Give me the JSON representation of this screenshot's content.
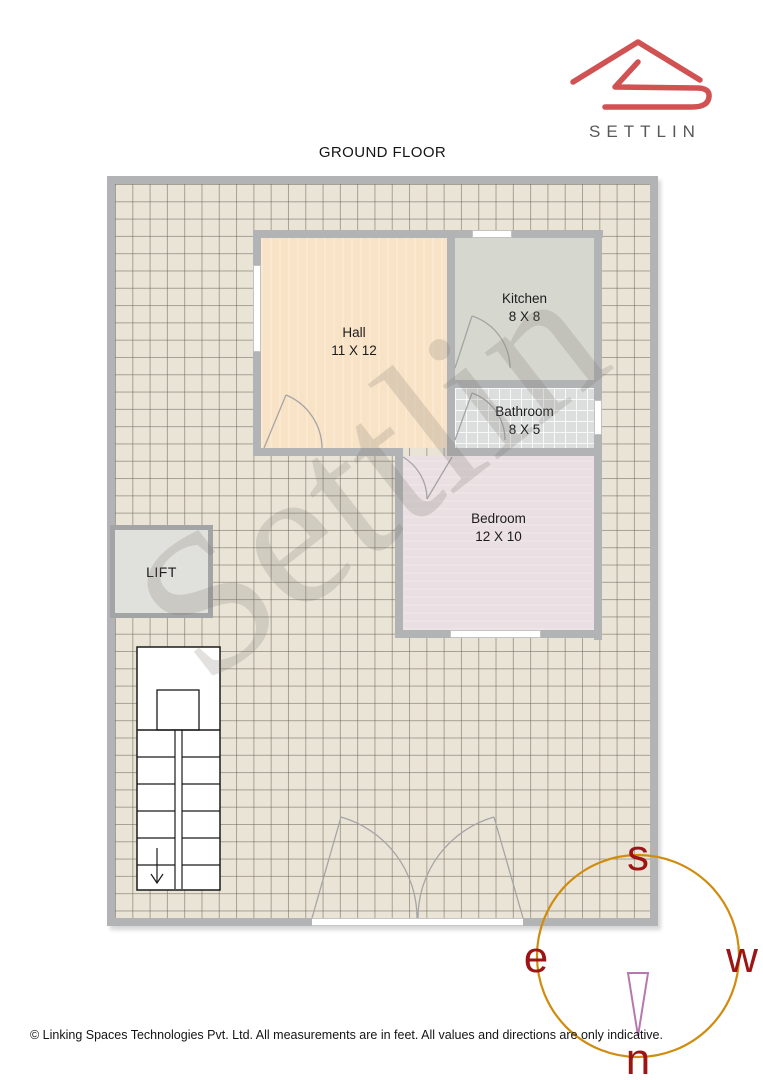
{
  "brand": {
    "name": "SETTLIN",
    "logo_color": "#d05252",
    "text_color": "#57585a"
  },
  "floor": {
    "title": "GROUND FLOOR"
  },
  "watermark": {
    "text": "Settlin"
  },
  "rooms": {
    "hall": {
      "name": "Hall",
      "size": "11 X 12",
      "fill": "#f9e3c6"
    },
    "kitchen": {
      "name": "Kitchen",
      "size": "8 X 8",
      "fill": "#d6d8d0"
    },
    "bathroom": {
      "name": "Bathroom",
      "size": "8 X 5",
      "fill": "#dcdedd"
    },
    "bedroom": {
      "name": "Bedroom",
      "size": "12 X 10",
      "fill": "#eadfe2"
    },
    "lift": {
      "name": "LIFT",
      "fill": "#e0e1dc"
    }
  },
  "compass": {
    "south": "s",
    "east": "e",
    "west": "w",
    "north": "n",
    "ring_color": "#cf8c0e",
    "letter_color": "#9c1414",
    "needle_color": "#b678ae"
  },
  "footer": {
    "copyright": "© Linking Spaces Technologies Pvt. Ltd. All measurements are in feet. All values and directions are only indicative."
  }
}
